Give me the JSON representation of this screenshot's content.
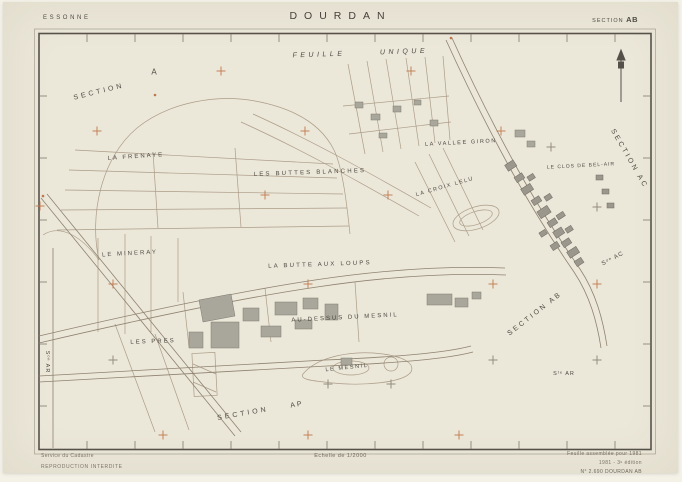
{
  "header": {
    "department": "ESSONNE",
    "commune": "DOURDAN",
    "section_label": "SECTION",
    "section_value": "AB"
  },
  "footer": {
    "left_line1": "Service du Cadastre",
    "left_line2": "REPRODUCTION INTERDITE",
    "scale": "Echelle de 1/2000",
    "right_line1": "Feuille assemblée pour 1981",
    "right_line2": "1981 - 3ᵉ édition",
    "right_line3": "N° 2.690 DOURDAN AB"
  },
  "icons": {
    "north_arrow": "north-arrow-icon"
  },
  "colors": {
    "paper": "#ebe7d9",
    "frame": "#56524a",
    "ink": "#4e4a42",
    "linework": "#a5947f",
    "tick": "#6f6a5f",
    "cross_orange": "#c0764a",
    "cross_dark": "#8a8274"
  },
  "map": {
    "labels": [
      {
        "text": "FEUILLE",
        "x": 316,
        "y": 53,
        "rot": -2,
        "fs": 7,
        "ls": 3.5,
        "italic": true
      },
      {
        "text": "UNIQUE",
        "x": 401,
        "y": 50,
        "rot": -2,
        "fs": 7,
        "ls": 3.5,
        "italic": true
      },
      {
        "text": "A",
        "x": 151,
        "y": 70,
        "rot": 0,
        "fs": 8,
        "ls": 0
      },
      {
        "text": "SECTION",
        "x": 96,
        "y": 90,
        "rot": -14,
        "fs": 7,
        "ls": 3
      },
      {
        "text": "LA FRENAYE",
        "x": 133,
        "y": 155,
        "rot": -4,
        "fs": 6,
        "ls": 2
      },
      {
        "text": "LES BUTTES BLANCHES",
        "x": 307,
        "y": 171,
        "rot": -2,
        "fs": 6,
        "ls": 2.2
      },
      {
        "text": "LA VALLEE GIRON",
        "x": 458,
        "y": 141,
        "rot": -3,
        "fs": 5.5,
        "ls": 1.6
      },
      {
        "text": "LA CROIX LELU",
        "x": 442,
        "y": 185,
        "rot": -16,
        "fs": 5.5,
        "ls": 1.5
      },
      {
        "text": "LE CLOS DE BEL-AIR",
        "x": 578,
        "y": 164,
        "rot": -3,
        "fs": 5,
        "ls": 1
      },
      {
        "text": "LE MINERAY",
        "x": 127,
        "y": 252,
        "rot": -3,
        "fs": 6,
        "ls": 2
      },
      {
        "text": "LA BUTTE AUX LOUPS",
        "x": 317,
        "y": 263,
        "rot": -2,
        "fs": 6,
        "ls": 2.2
      },
      {
        "text": "AU-DESSUS DU MESNIL",
        "x": 342,
        "y": 316,
        "rot": -3,
        "fs": 6,
        "ls": 2
      },
      {
        "text": "LES PRES",
        "x": 150,
        "y": 340,
        "rot": -2,
        "fs": 6,
        "ls": 2
      },
      {
        "text": "LE MESNIL",
        "x": 344,
        "y": 366,
        "rot": -6,
        "fs": 5.5,
        "ls": 1.6
      },
      {
        "text": "SECTION",
        "x": 240,
        "y": 412,
        "rot": -10,
        "fs": 7,
        "ls": 3
      },
      {
        "text": "AP",
        "x": 294,
        "y": 403,
        "rot": -10,
        "fs": 7,
        "ls": 2
      },
      {
        "text": "SECTION AB",
        "x": 532,
        "y": 312,
        "rot": -38,
        "fs": 7,
        "ls": 2.5
      },
      {
        "text": "SECTION AC",
        "x": 626,
        "y": 157,
        "rot": 60,
        "fs": 7,
        "ls": 2.5
      },
      {
        "text": "Sᵒⁿ AC",
        "x": 610,
        "y": 257,
        "rot": -28,
        "fs": 6,
        "ls": 1
      },
      {
        "text": "Sᵗᵉ AR",
        "x": 561,
        "y": 372,
        "rot": 0,
        "fs": 5.5,
        "ls": 1
      },
      {
        "text": "Sᵒⁿ AR",
        "x": 44,
        "y": 360,
        "rot": 90,
        "fs": 5.5,
        "ls": 1
      }
    ],
    "crosses": [
      {
        "x": 218,
        "y": 69,
        "c": "o"
      },
      {
        "x": 408,
        "y": 69,
        "c": "o"
      },
      {
        "x": 94,
        "y": 129,
        "c": "o"
      },
      {
        "x": 302,
        "y": 129,
        "c": "o"
      },
      {
        "x": 498,
        "y": 129,
        "c": "o"
      },
      {
        "x": 37,
        "y": 204,
        "c": "o"
      },
      {
        "x": 262,
        "y": 193,
        "c": "o"
      },
      {
        "x": 385,
        "y": 193,
        "c": "o"
      },
      {
        "x": 548,
        "y": 145,
        "c": "d"
      },
      {
        "x": 594,
        "y": 205,
        "c": "d"
      },
      {
        "x": 110,
        "y": 282,
        "c": "o"
      },
      {
        "x": 305,
        "y": 282,
        "c": "o"
      },
      {
        "x": 490,
        "y": 282,
        "c": "o"
      },
      {
        "x": 594,
        "y": 282,
        "c": "o"
      },
      {
        "x": 110,
        "y": 358,
        "c": "d"
      },
      {
        "x": 490,
        "y": 358,
        "c": "d"
      },
      {
        "x": 594,
        "y": 358,
        "c": "d"
      },
      {
        "x": 325,
        "y": 382,
        "c": "d"
      },
      {
        "x": 388,
        "y": 382,
        "c": "d"
      },
      {
        "x": 160,
        "y": 433,
        "c": "o"
      },
      {
        "x": 305,
        "y": 433,
        "c": "o"
      },
      {
        "x": 456,
        "y": 433,
        "c": "o"
      }
    ]
  }
}
